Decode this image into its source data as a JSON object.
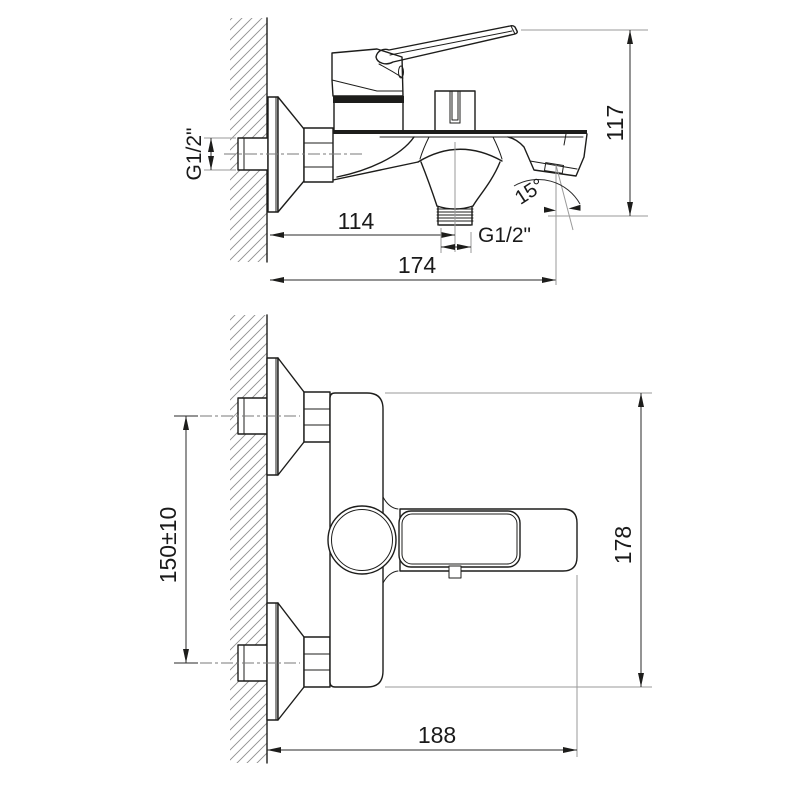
{
  "drawing": {
    "subject": "wall-mounted bath-shower mixer faucet dimensional drawing",
    "background": "#ffffff",
    "line_color": "#1d1d1b",
    "views": {
      "side_view": {
        "name": "side view",
        "dims": {
          "inlet_thread": "G1/2\"",
          "overall_height": "117",
          "wall_to_shower_outlet": "114",
          "shower_outlet_thread": "G1/2\"",
          "wall_to_spout_outlet": "174",
          "spout_angle": "15°"
        }
      },
      "front_view": {
        "name": "front view",
        "dims": {
          "inlet_centers_spacing": "150±10",
          "body_height": "178",
          "overall_depth": "188"
        }
      }
    }
  }
}
